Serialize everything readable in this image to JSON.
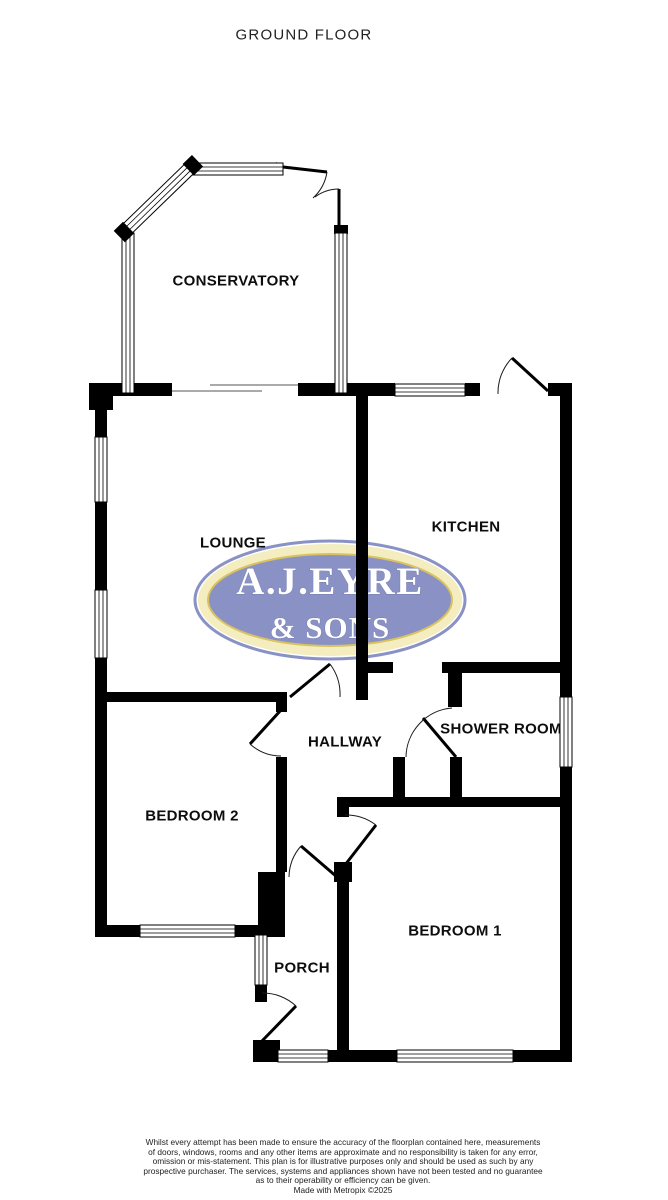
{
  "title": "GROUND FLOOR",
  "rooms": {
    "conservatory": "CONSERVATORY",
    "lounge": "LOUNGE",
    "kitchen": "KITCHEN",
    "hallway": "HALLWAY",
    "shower_room": "SHOWER ROOM",
    "bedroom2": "BEDROOM 2",
    "bedroom1": "BEDROOM 1",
    "porch": "PORCH"
  },
  "logo": {
    "line1": "A.J.EYRE",
    "line2": "& SONS",
    "colors": {
      "body": "#8a92c5",
      "band": "#f3edc0",
      "gold": "#d9c25f",
      "text": "#ffffff"
    }
  },
  "disclaimer": {
    "lines": [
      "Whilst every attempt has been made to ensure the accuracy of the floorplan contained here, measurements",
      "of doors, windows, rooms and any other items are approximate and no responsibility is taken for any error,",
      "omission or mis-statement. This plan is for illustrative purposes only and should be used as such by any",
      "prospective purchaser. The services, systems and appliances shown have not been tested and no guarantee",
      "as to their operability or efficiency can be given."
    ],
    "credit": "Made with Metropix ©2025"
  },
  "colors": {
    "wall": "#000000",
    "background": "#ffffff"
  }
}
